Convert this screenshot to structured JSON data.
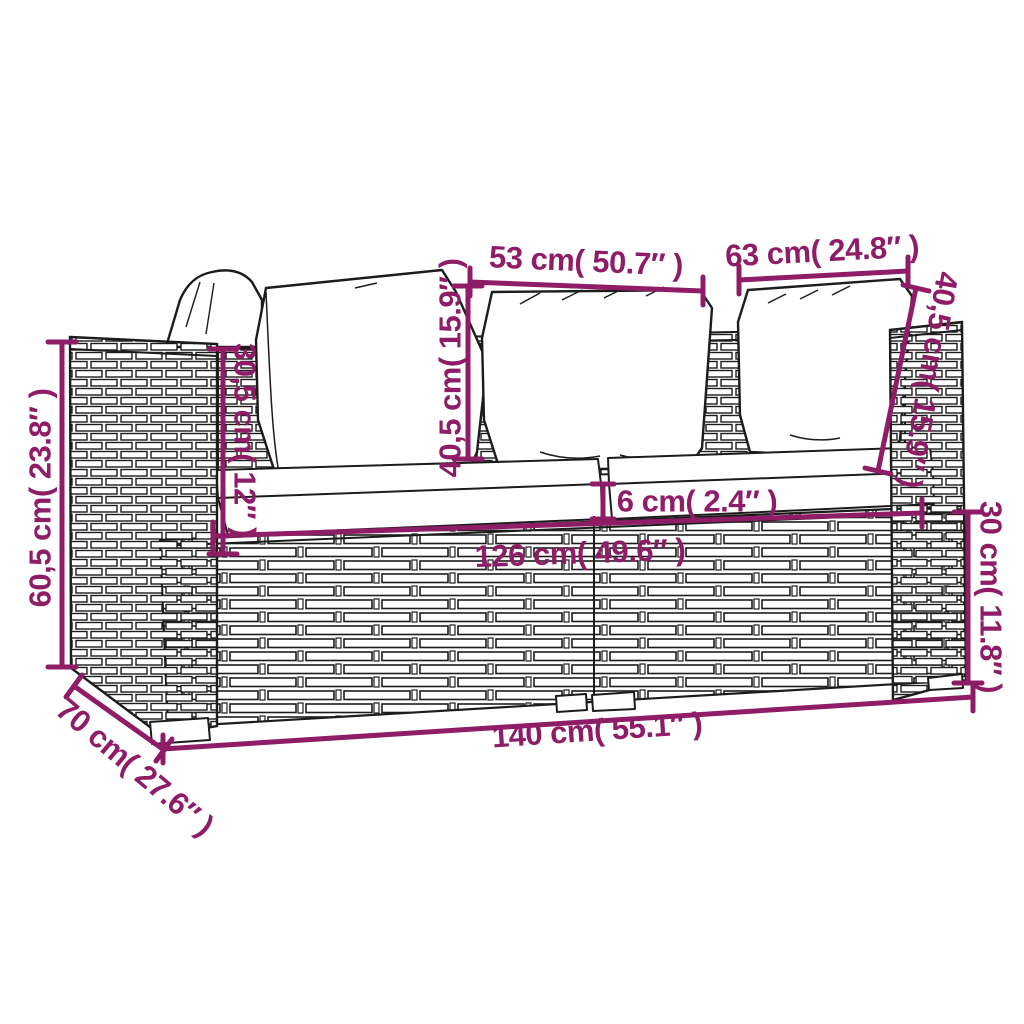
{
  "diagram": {
    "title": "2-seater poly rattan garden sofa with cushions — dimension drawing",
    "accent_color": "#8E1C66",
    "outline_color": "#1c1c1c",
    "cushion_color": "#ffffff",
    "dimensions": {
      "back_cushion_width_left": {
        "label": "53 cm( 50.7″ )"
      },
      "back_cushion_width_right": {
        "label": "63 cm( 24.8″ )"
      },
      "back_cushion_height_middle": {
        "label": "40,5 cm( 15.9″ )"
      },
      "back_cushion_height_right": {
        "label": "40,5 cm( 15.9″ )"
      },
      "armrest_to_seat_height": {
        "label": "30,5 cm( 12″ )"
      },
      "total_height": {
        "label": "60,5 cm( 23.8″ )"
      },
      "depth": {
        "label": "70 cm( 27.6″ )"
      },
      "seat_cushion_thickness": {
        "label": "6 cm( 2.4″ )"
      },
      "seat_width": {
        "label": "126 cm( 49.6″ )"
      },
      "base_height": {
        "label": "30 cm( 11.8″ )"
      },
      "total_width": {
        "label": "140 cm( 55.1″ )"
      }
    }
  }
}
